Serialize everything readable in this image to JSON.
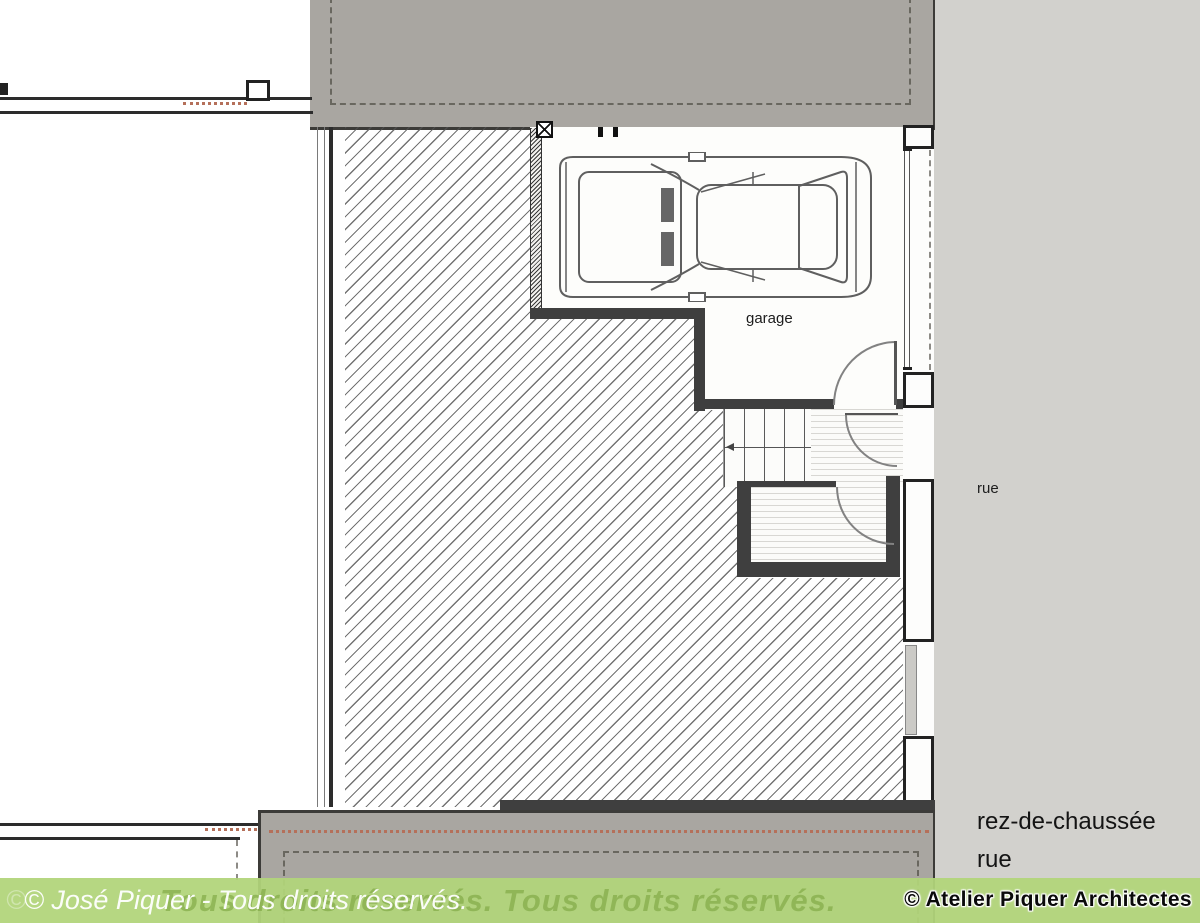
{
  "plan": {
    "labels": {
      "garage": "garage",
      "street_side": "rue",
      "floor_name": "rez-de-chaussée",
      "floor_street": "rue"
    }
  },
  "footer": {
    "ghost_copyright": "©",
    "owner_watermark": "© José Piquer - Tous droits réservés.",
    "ghost_watermark": "Tous droits réservés. Tous droits réservés.",
    "studio_credit": "© Atelier Piquer Architectes"
  },
  "colors": {
    "block_gray": "#a9a6a1",
    "street_gray": "#d2d1cd",
    "wall_dark": "#3f3f3f",
    "hatch_line": "#8a8a8a",
    "red_axis": "#b5705a",
    "footer_green": "#b1d57a"
  }
}
